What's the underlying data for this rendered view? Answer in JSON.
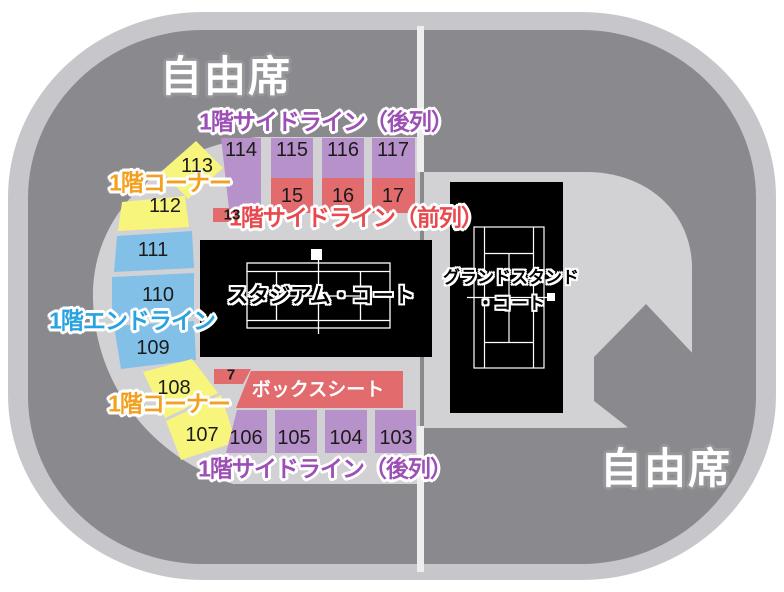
{
  "legend": {
    "free_seating": "自由席",
    "sideline_back": "1階サイドライン（後列）",
    "corner": "1階コーナー",
    "sideline_front": "1階サイドライン（前列）",
    "endline": "1階エンドライン",
    "box_seat": "ボックスシート",
    "stadium_court": "スタジアム・コート",
    "grandstand_court_line1": "グランドスタンド",
    "grandstand_court_line2": "・コート"
  },
  "sections": {
    "back_top": [
      "114",
      "115",
      "116",
      "117"
    ],
    "front_top": [
      "15",
      "16",
      "17"
    ],
    "strip_top": "13",
    "corner_top": [
      "113",
      "112"
    ],
    "endline": [
      "111",
      "110",
      "109"
    ],
    "corner_bottom": [
      "108",
      "107"
    ],
    "strip_bottom": "7",
    "back_bottom": [
      "106",
      "105",
      "104",
      "103"
    ]
  },
  "colors": {
    "purple_block": "#b791c9",
    "red_block": "#e26b6e",
    "yellow_block": "#f8f57d",
    "blue_block": "#82c0e8",
    "ring_dark": "#8a8a8e",
    "rim_light": "#c7c7cb",
    "inner_light": "#d2d2d5",
    "court_black": "#000000",
    "court_line": "#ffffff",
    "label_purple": "#9c4fb4",
    "label_orange": "#f3a01f",
    "label_red": "#e8494f",
    "label_blue": "#29a3df",
    "free_seat_outline": "#97979b"
  }
}
